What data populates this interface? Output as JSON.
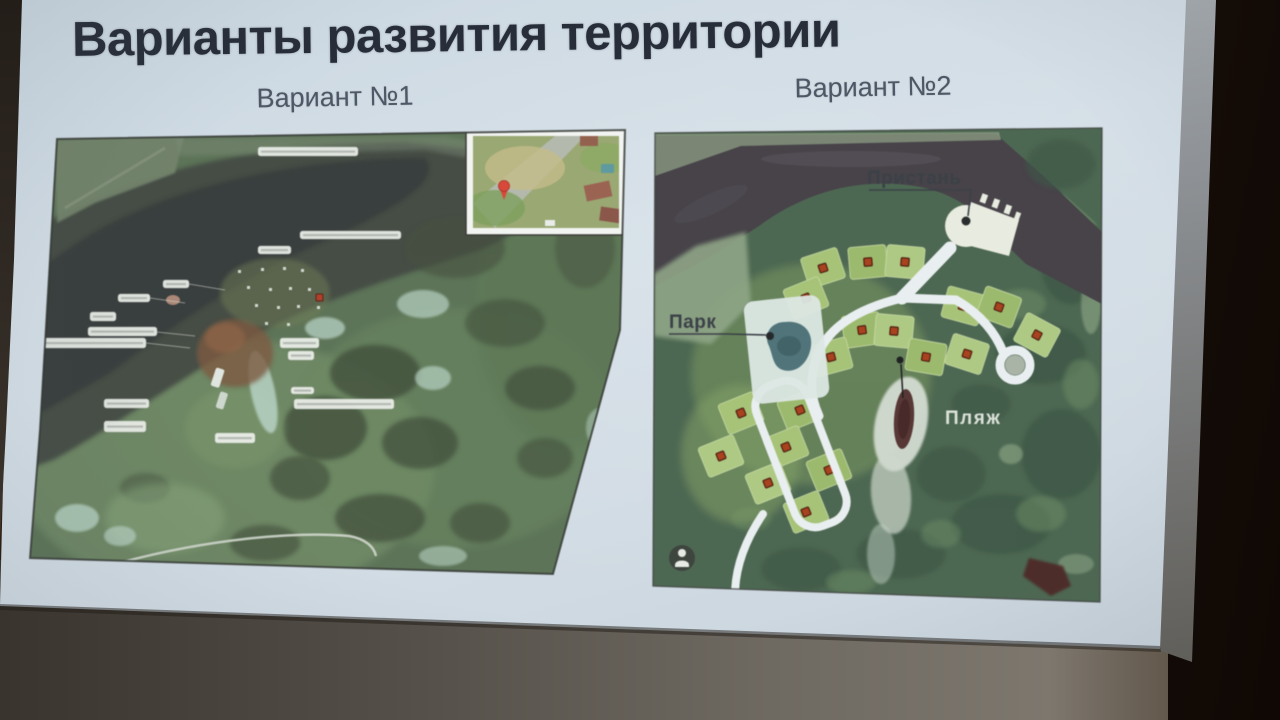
{
  "slide": {
    "title": "Варианты развития территории",
    "variant1_label": "Вариант №1",
    "variant2_label": "Вариант №2"
  },
  "map_variant_2": {
    "pier_label": "Пристань",
    "park_label": "Парк",
    "beach_label": "Пляж"
  },
  "icons": {
    "pegman": "person-in-circle-icon",
    "map_pin": "red-map-pin-icon"
  },
  "colors": {
    "screen": "#d2dde5",
    "title_text": "#272e3a",
    "subtitle_text": "#4d5765",
    "map_label_text": "#3b4148",
    "water": "#474349",
    "forest": "#4d6852",
    "plot_green": "#a6c378",
    "plot_marker": "#a8421f",
    "road": "#e9eef0"
  }
}
